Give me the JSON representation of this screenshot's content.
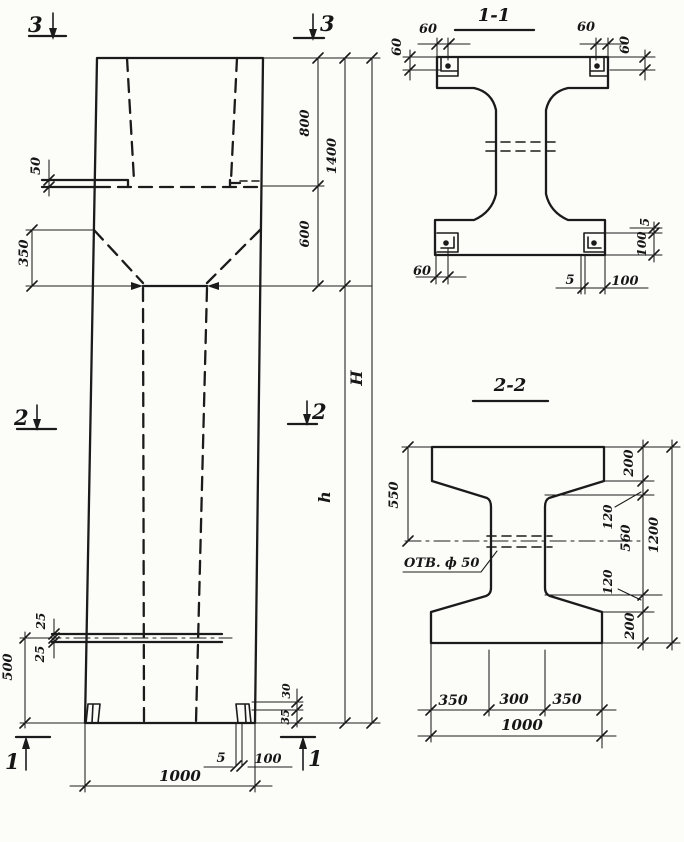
{
  "elevation": {
    "marker_top": "3",
    "marker_mid": "2",
    "marker_bottom": "1",
    "dim_50": "50",
    "dim_350": "350",
    "dim_800": "800",
    "dim_1400": "1400",
    "dim_600": "600",
    "dim_H": "H",
    "dim_h": "h",
    "dim_25_top": "25",
    "dim_25_bottom": "25",
    "dim_500": "500",
    "dim_30": "30",
    "dim_35": "35",
    "dim_5": "5",
    "dim_100": "100",
    "dim_1000": "1000"
  },
  "section11": {
    "title": "1-1",
    "dim_60_top_left_h": "60",
    "dim_60_top_left_v": "60",
    "dim_60_top_right_h": "60",
    "dim_60_top_right_v": "60",
    "dim_60_bottom_left": "60",
    "dim_5_bottom": "5",
    "dim_100_bottom": "100",
    "dim_5_right": "5",
    "dim_100_right": "100"
  },
  "section22": {
    "title": "2-2",
    "dim_550": "550",
    "dim_200_top": "200",
    "dim_120_top": "120",
    "dim_560": "560",
    "dim_120_bottom": "120",
    "dim_200_bottom": "200",
    "dim_1200": "1200",
    "dim_350_left": "350",
    "dim_300": "300",
    "dim_350_right": "350",
    "dim_1000": "1000",
    "hole_label": "ОТВ. ф 50"
  }
}
